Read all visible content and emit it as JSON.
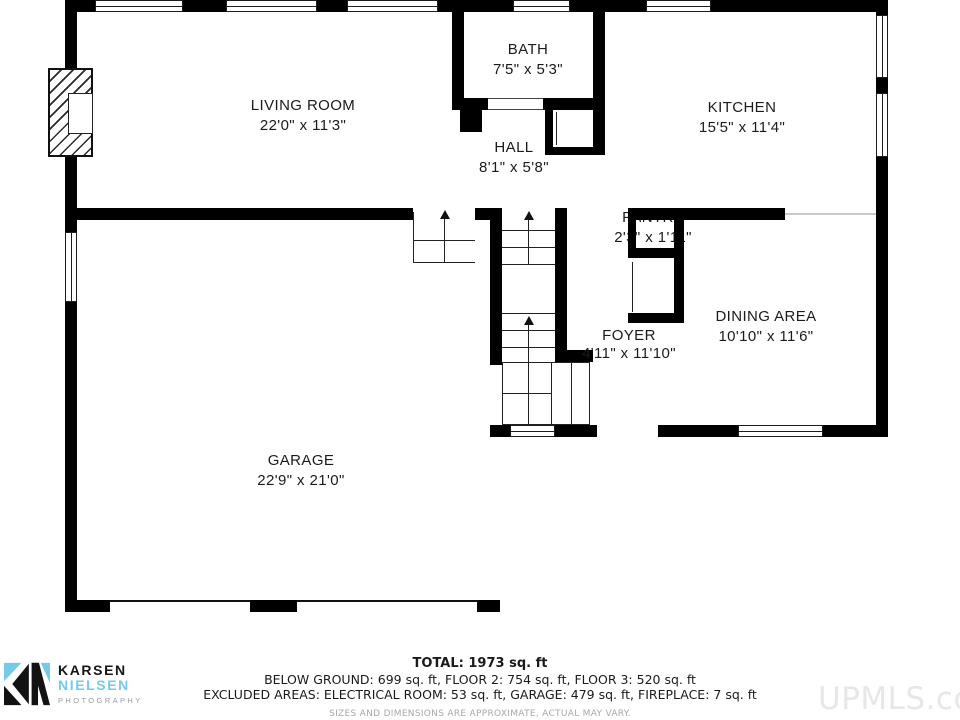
{
  "rooms": [
    {
      "name": "LIVING ROOM",
      "dims": "22'0\" x 11'3\""
    },
    {
      "name": "BATH",
      "dims": "7'5\" x 5'3\""
    },
    {
      "name": "HALL",
      "dims": "8'1\" x 5'8\""
    },
    {
      "name": "KITCHEN",
      "dims": "15'5\" x 11'4\""
    },
    {
      "name": "PANTRY",
      "dims": "2'3\" x 1'11\""
    },
    {
      "name": "DINING AREA",
      "dims": "10'10\" x 11'6\""
    },
    {
      "name": "FOYER",
      "dims": "4'11\" x 11'10\""
    },
    {
      "name": "GARAGE",
      "dims": "22'9\" x 21'0\""
    }
  ],
  "footer": {
    "total": "TOTAL: 1973 sq. ft",
    "floors": "BELOW GROUND: 699 sq. ft, FLOOR 2: 754 sq. ft, FLOOR 3: 520 sq. ft",
    "excluded": "EXCLUDED AREAS: ELECTRICAL ROOM: 53 sq. ft, GARAGE: 479 sq. ft, FIREPLACE: 7 sq. ft",
    "disclaimer": "SIZES AND DIMENSIONS ARE APPROXIMATE, ACTUAL MAY VARY."
  },
  "logo": {
    "line1": "KARSEN",
    "line2": "NIELSEN",
    "line3": "PHOTOGRAPHY"
  },
  "watermark": "UPMLS.com",
  "colors": {
    "wall": "#000000",
    "logo_blue": "#76c9e7",
    "logo_gray": "#9a9a9a",
    "watermark_gray": "#e7e7e7"
  }
}
